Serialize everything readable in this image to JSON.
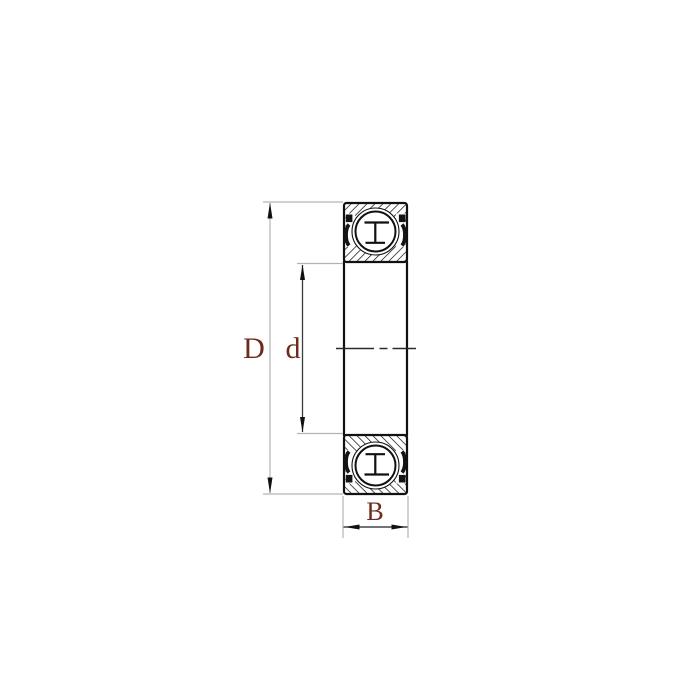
{
  "diagram": {
    "kind": "sealed deep groove ball bearing cross-section drawing",
    "labels": {
      "outer_diameter": "D",
      "bore_diameter": "d",
      "width": "B"
    },
    "colors": {
      "label_text": "#6e2a1a",
      "object_line": "#111111",
      "extension_line": "#b3b3b3",
      "dimension_line": "#3c3c3c",
      "seal": "#141414",
      "background": "#ffffff"
    }
  }
}
